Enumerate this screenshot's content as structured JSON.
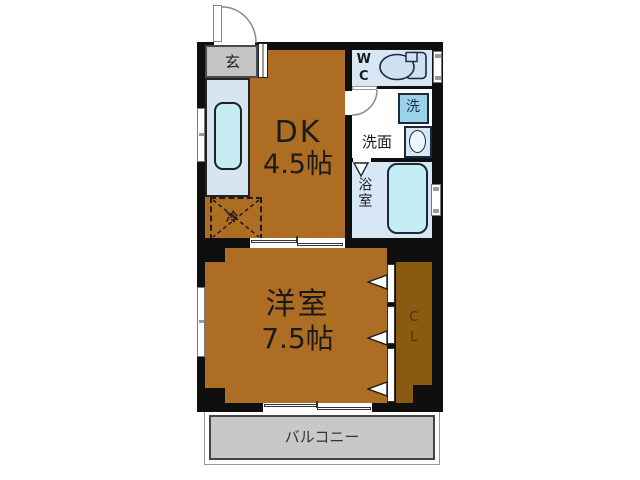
{
  "rooms": {
    "entrance": {
      "label": "玄"
    },
    "dining_kitchen": {
      "name": "DK",
      "size": "4.5帖"
    },
    "toilet": {
      "label": "WC"
    },
    "washroom": {
      "label": "洗面"
    },
    "laundry_space": {
      "label": "洗"
    },
    "bathroom": {
      "label": "浴室"
    },
    "western_room": {
      "name": "洋室",
      "size": "7.5帖"
    },
    "closet": {
      "label": "CL"
    },
    "refrigerator_space": {
      "label": "冷"
    },
    "balcony": {
      "label": "バルコニー"
    }
  },
  "colors": {
    "room_floor": "#ad6d23",
    "closet_floor": "#8a5a10",
    "wall": "#0f0f0f",
    "wet_area_blue": "#d7e7f5",
    "fixture_cyan": "#c5edf3",
    "washer_blue": "#9cd2e8",
    "entrance_gray": "#c4c4c4",
    "balcony_gray": "#c8c8c8"
  }
}
